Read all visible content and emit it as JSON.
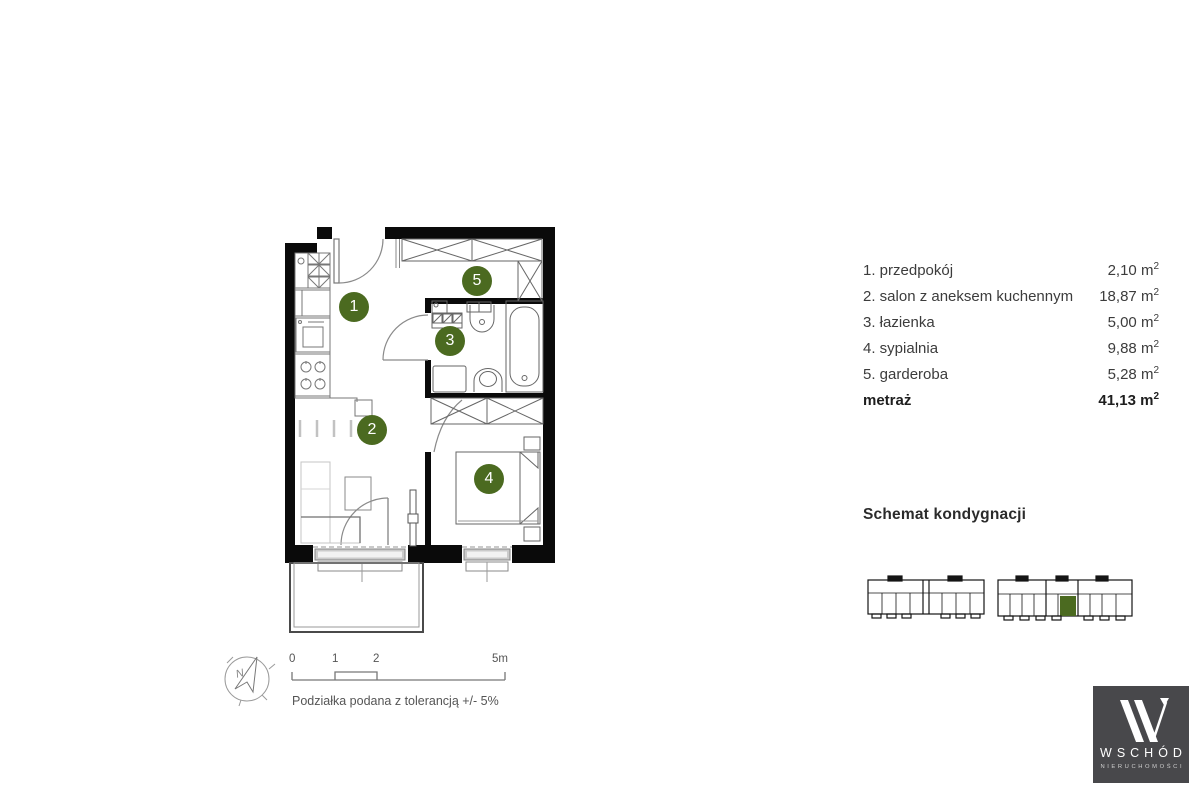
{
  "legend": {
    "rows": [
      {
        "num": "1",
        "label": "1. przedpokój",
        "area": "2,10"
      },
      {
        "num": "2",
        "label": "2. salon z aneksem kuchennym",
        "area": "18,87"
      },
      {
        "num": "3",
        "label": "3. łazienka",
        "area": "5,00"
      },
      {
        "num": "4",
        "label": "4. sypialnia",
        "area": "9,88"
      },
      {
        "num": "5",
        "label": "5. garderoba",
        "area": "5,28"
      }
    ],
    "total_label": "metraż",
    "total_area": "41,13",
    "unit_base": "m",
    "unit_sup": "2"
  },
  "floor_scheme": {
    "title": "Schemat kondygnacji"
  },
  "scale_bar": {
    "ticks": [
      "0",
      "1",
      "2",
      "5m"
    ],
    "tolerance_note": "Podziałka podana z tolerancją +/- 5%"
  },
  "compass": {
    "north_label": "N"
  },
  "logo": {
    "brand": "WSCHÓD",
    "subtitle": "NIERUCHOMOŚCI",
    "bg_color": "#48484b"
  },
  "colors": {
    "room_badge_green": "#4b6a20",
    "unit_highlight_green": "#4b6a20",
    "wall_black": "#0a0a0a"
  }
}
